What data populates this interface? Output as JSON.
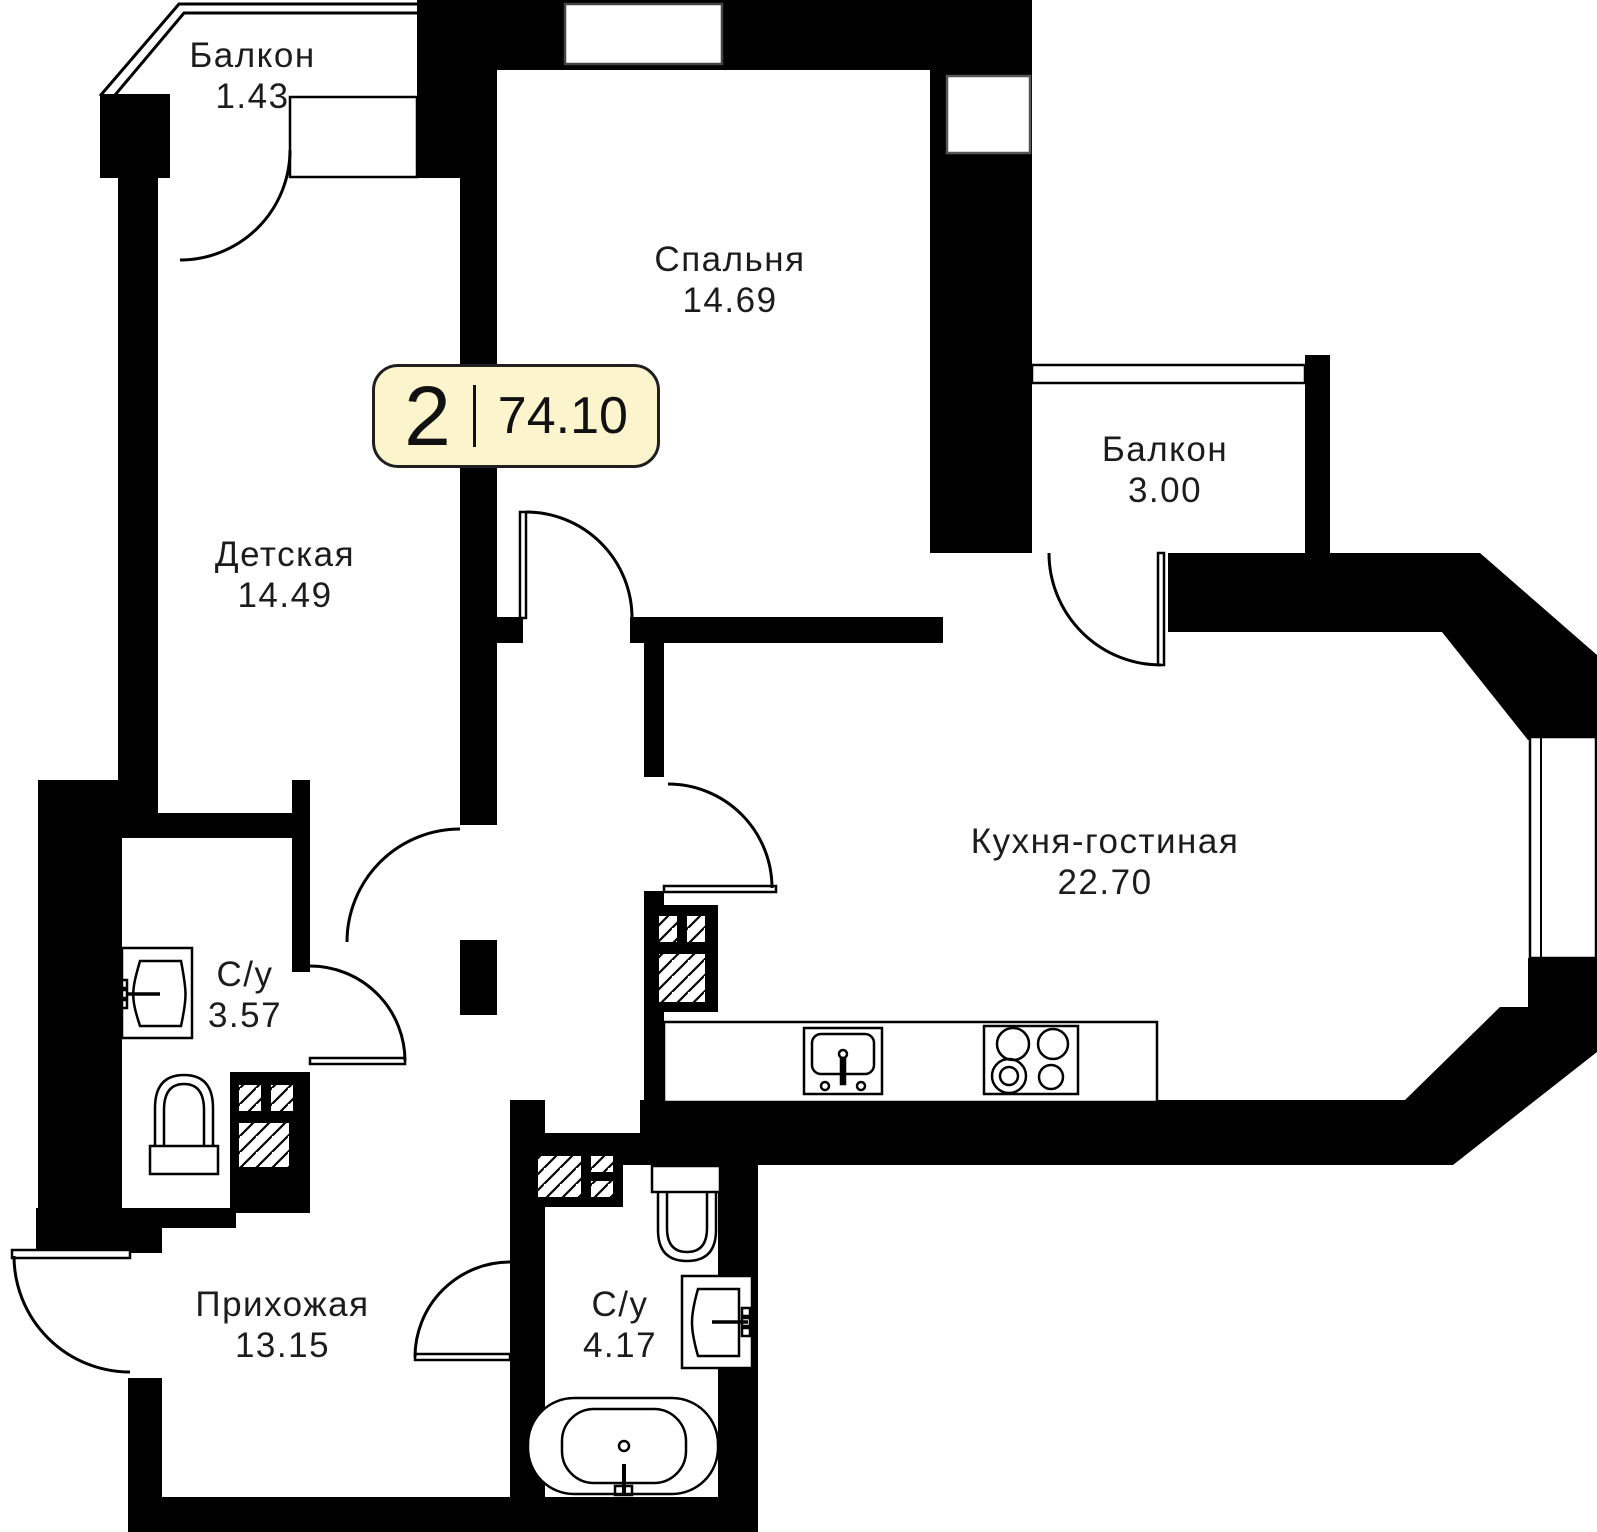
{
  "badge": {
    "rooms": "2",
    "area": "74.10"
  },
  "rooms": [
    {
      "id": "balcony-top",
      "name": "Балкон",
      "area": "1.43"
    },
    {
      "id": "bedroom",
      "name": "Спальня",
      "area": "14.69"
    },
    {
      "id": "balcony-right",
      "name": "Балкон",
      "area": "3.00"
    },
    {
      "id": "kids-room",
      "name": "Детская",
      "area": "14.49"
    },
    {
      "id": "kitchen-living",
      "name": "Кухня-гостиная",
      "area": "22.70"
    },
    {
      "id": "bathroom-small",
      "name": "С/у",
      "area": "3.57"
    },
    {
      "id": "hallway",
      "name": "Прихожая",
      "area": "13.15"
    },
    {
      "id": "bathroom-big",
      "name": "С/у",
      "area": "4.17"
    }
  ],
  "colors": {
    "wall": "#000000",
    "badge_bg": "#FBF4CC",
    "badge_border": "#1f1f1f",
    "text": "#1c1c1c"
  },
  "fixtures": [
    "sink-icon",
    "toilet-icon",
    "bathtub-icon",
    "stove-icon",
    "kitchen-sink-icon",
    "vent-shaft-icon",
    "door-arc-icon",
    "window-icon",
    "balcony-railing-icon"
  ]
}
